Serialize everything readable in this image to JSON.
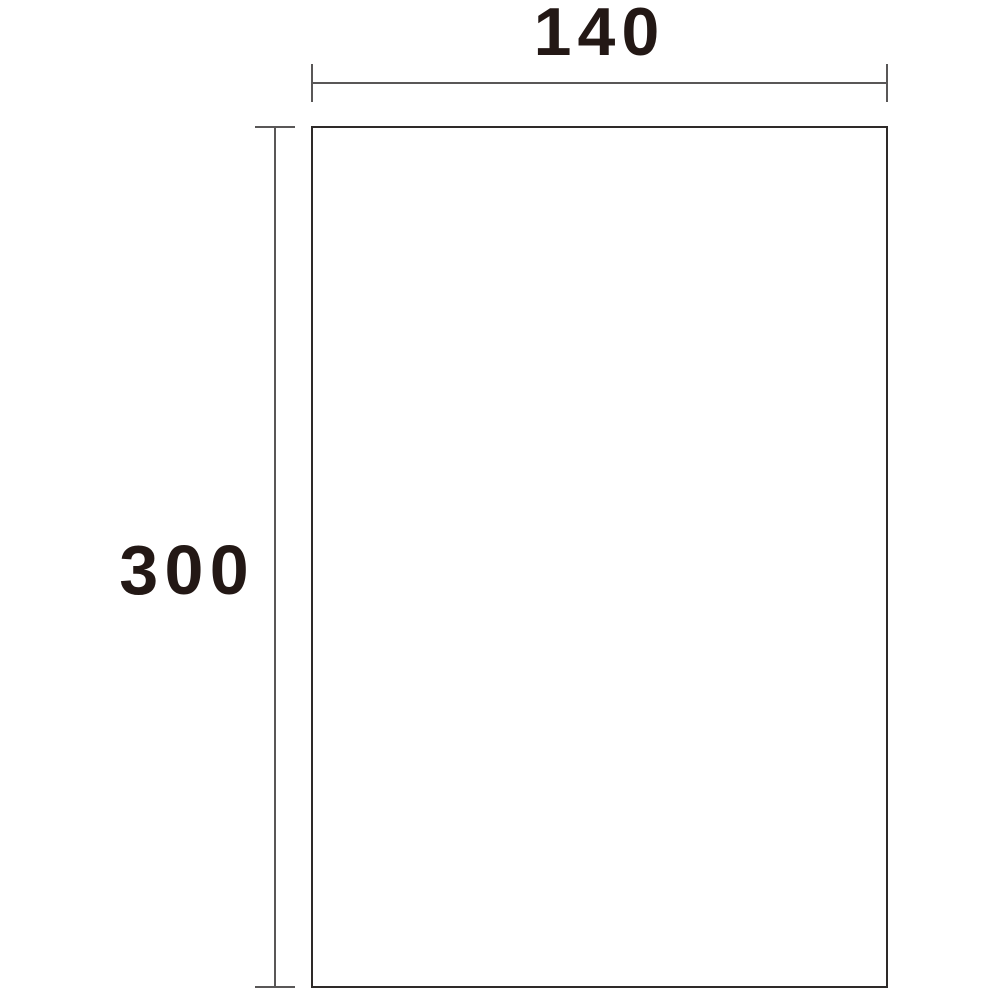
{
  "diagram": {
    "type": "product-dimension-diagram",
    "width_label": "140",
    "height_label": "300"
  },
  "colors": {
    "label_text": "#231815",
    "dimension_line": "#595757",
    "rectangle_border": "#2e2a29",
    "background": "#ffffff"
  }
}
